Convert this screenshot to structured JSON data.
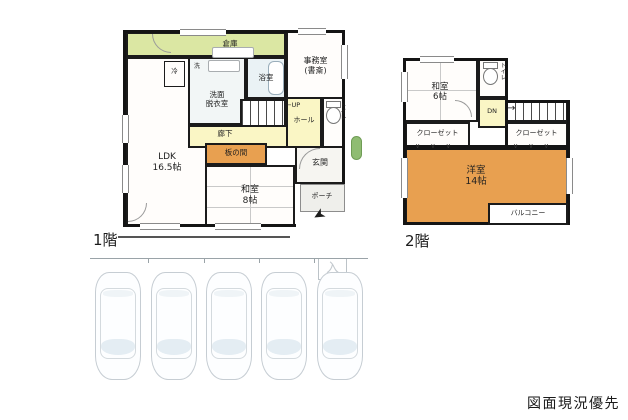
{
  "meta": {
    "disclaimer": "図面現況優先"
  },
  "colors": {
    "wall": "#1b1b1b",
    "storage_green": "#dbe7a3",
    "hall_yellow": "#faf6c5",
    "room_orange": "#e8a050",
    "bath_blue": "#eaf2f5",
    "plant_green": "#8fbc72",
    "tatami_line": "#c9c9c9",
    "car_outline": "#c6cdd3"
  },
  "floor1": {
    "title": "1階",
    "storage": "倉庫",
    "office_line1": "事務室",
    "office_line2": "(書斎)",
    "fridge": "冷",
    "washer": "洗",
    "washroom_line1": "洗面",
    "washroom_line2": "脱衣室",
    "bath": "浴室",
    "up": "UP",
    "hall": "ホール",
    "toilet": "トイレ",
    "corridor": "廊下",
    "itanoma": "板の間",
    "entrance": "玄関",
    "porch": "ポーチ",
    "ldk_line1": "LDK",
    "ldk_line2": "16.5帖",
    "washitsu_line1": "和室",
    "washitsu_line2": "8帖"
  },
  "floor2": {
    "title": "2階",
    "washitsu_line1": "和室",
    "washitsu_line2": "6帖",
    "toilet": "トイレ",
    "dn": "DN",
    "closet_left": "クローゼット",
    "closet_right": "クローゼット",
    "western_line1": "洋室",
    "western_line2": "14帖",
    "balcony": "バルコニー"
  },
  "parking": {
    "entry_mark": "入",
    "car_count": 5
  },
  "icons": {
    "up_arrow": "←",
    "dn_arrow": "→",
    "north_arrow": "➤",
    "fold_marks": "∨ ∨ ∨"
  }
}
